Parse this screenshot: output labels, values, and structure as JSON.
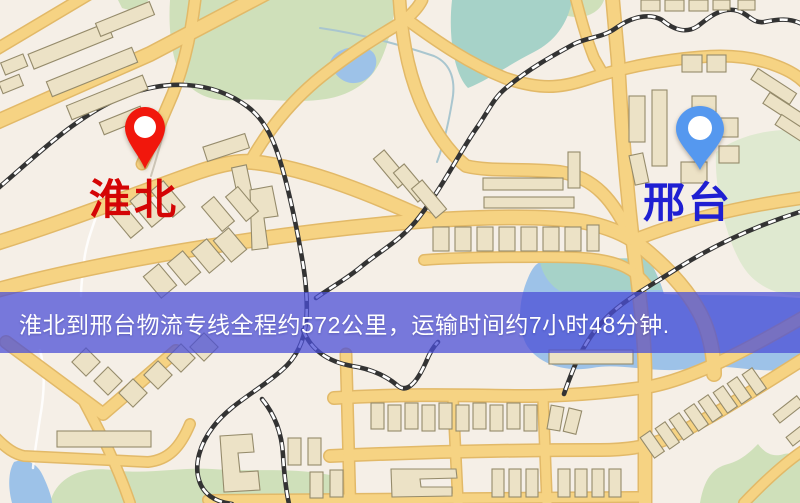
{
  "banner": {
    "text": "淮北到邢台物流专线全程约572公里，运输时间约7小时48分钟."
  },
  "markers": {
    "origin": {
      "label": "淮北",
      "icon": "red-map-pin"
    },
    "destination": {
      "label": "邢台",
      "icon": "blue-map-pin"
    }
  },
  "route_info": {
    "origin_city": "淮北",
    "destination_city": "邢台",
    "distance_km": "572",
    "duration": "7小时48分钟"
  },
  "theme": {
    "map-bg": "#f5efe7",
    "road": "#f6d383",
    "road-edge": "#e2b968",
    "park": "#cfe0ba",
    "park-pale": "#dfe9d0",
    "water-blue": "#9dc2e8",
    "water-teal": "#a6d2c8",
    "building": "#ece2c6",
    "building-edge": "#958b6b",
    "rail": "#333333",
    "stream": "#a9c6cf",
    "banner-bg": "rgba(74,78,214,0.74)",
    "banner-text": "#ffffff",
    "origin-pin": "#f1170c",
    "origin-label": "#d40505",
    "dest-pin": "#5598ef",
    "dest-label": "#1f1fd2"
  }
}
